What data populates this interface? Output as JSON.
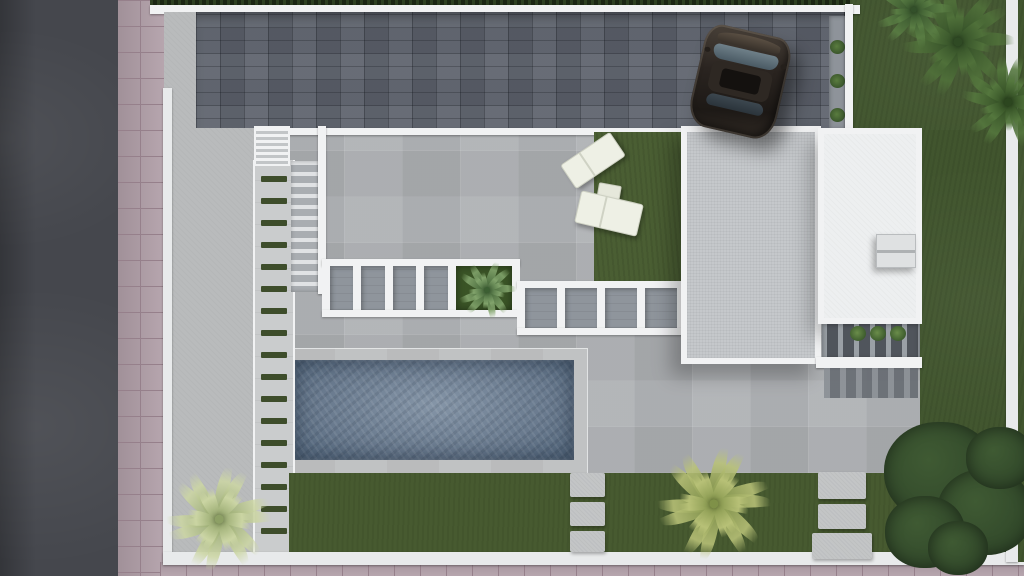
{
  "meta": {
    "description": "Top-down aerial 3D architectural render of a modern villa plot: asphalt road and pink tiled sidewalk on the left, dark paver driveway with a parked SUV on top, two flat white roofs, concrete terrace with pergola walkways and staircase, rectangular swimming pool, green lawns, palm trees and a large bush",
    "canvas": {
      "width": 1024,
      "height": 576
    }
  },
  "palette": {
    "road": "#45474d",
    "sidewalk": "#b3a1aa",
    "sidewalk_line": "#96808b",
    "hedge": "#1c2714",
    "wall": "#e8eaeb",
    "wall_bright": "#f1f2f3",
    "driveway": "#5c616b",
    "concrete": "#b9bbbc",
    "walkway": "#cacccd",
    "terrace": "#aeb1b4",
    "stripe": "#3e4d2b",
    "lawn": "#41552e",
    "lawn_bottom": "#475a30",
    "lawn_patch": "#4a5e33",
    "pool_deck": "#bec0c1",
    "pool_hi": "#8595a7",
    "pool_mid": "#68798d",
    "pool_lo": "#586b80",
    "roof_inner": "#c5c8cb",
    "roof_white": "#edeff0",
    "opening": "#8f959c",
    "slat_dark": "#50555c",
    "slat_light": "#9aa0a6",
    "lounger": "#eef0e5",
    "table": "#e6e8db",
    "planter_green": "#3a5426",
    "bush": "#31482a"
  },
  "scene": {
    "walkway_stripes": {
      "count": 17,
      "first_y": 16,
      "spacing": 22
    },
    "pergola_upper": {
      "x": 322,
      "y": 259,
      "width": 198,
      "height": 58,
      "cells": [
        "opening",
        "opening",
        "opening",
        "opening",
        "planter"
      ]
    },
    "pergola_lower": {
      "x": 517,
      "y": 281,
      "width": 168,
      "height": 54,
      "cells": [
        "opening",
        "opening",
        "opening",
        "opening"
      ]
    },
    "stepping_stones": [
      {
        "x": 570,
        "y": 473,
        "w": 35,
        "h": 24
      },
      {
        "x": 570,
        "y": 502,
        "w": 35,
        "h": 24
      },
      {
        "x": 570,
        "y": 531,
        "w": 35,
        "h": 21
      },
      {
        "x": 818,
        "y": 472,
        "w": 48,
        "h": 27
      },
      {
        "x": 818,
        "y": 504,
        "w": 48,
        "h": 25
      },
      {
        "x": 812,
        "y": 533,
        "w": 60,
        "h": 26
      }
    ],
    "palms": [
      {
        "name": "palm-top-right-a",
        "cx": 958,
        "cy": 42,
        "r": 58,
        "fronds": 11,
        "core": "#2f4a24",
        "tip": "#50713a"
      },
      {
        "name": "palm-top-right-b",
        "cx": 1008,
        "cy": 102,
        "r": 48,
        "fronds": 10,
        "core": "#2c461f",
        "tip": "#55783e"
      },
      {
        "name": "palm-top-right-c",
        "cx": 914,
        "cy": 10,
        "r": 40,
        "fronds": 9,
        "core": "#33502a",
        "tip": "#5a7e44"
      },
      {
        "name": "palm-bottom-left",
        "cx": 219,
        "cy": 519,
        "r": 54,
        "fronds": 12,
        "core": "#8da065",
        "tip": "#ccd6a4"
      },
      {
        "name": "palm-bottom-center",
        "cx": 714,
        "cy": 504,
        "r": 58,
        "fronds": 12,
        "core": "#7f9148",
        "tip": "#b9c278"
      },
      {
        "name": "planter-plant",
        "cx": 487,
        "cy": 290,
        "r": 30,
        "fronds": 9,
        "core": "#3c5f33",
        "tip": "#83a56d"
      }
    ],
    "bush_blobs": [
      {
        "cx": 940,
        "cy": 472,
        "r": 56
      },
      {
        "cx": 985,
        "cy": 512,
        "r": 48
      },
      {
        "cx": 925,
        "cy": 532,
        "r": 40
      },
      {
        "cx": 1000,
        "cy": 458,
        "r": 34
      },
      {
        "cx": 958,
        "cy": 548,
        "r": 30
      }
    ],
    "driveway_strip_plants": [
      {
        "y": 24
      },
      {
        "y": 58
      },
      {
        "y": 92
      }
    ],
    "slat_plants": [
      {
        "x": 28
      },
      {
        "x": 48
      },
      {
        "x": 68
      }
    ]
  }
}
